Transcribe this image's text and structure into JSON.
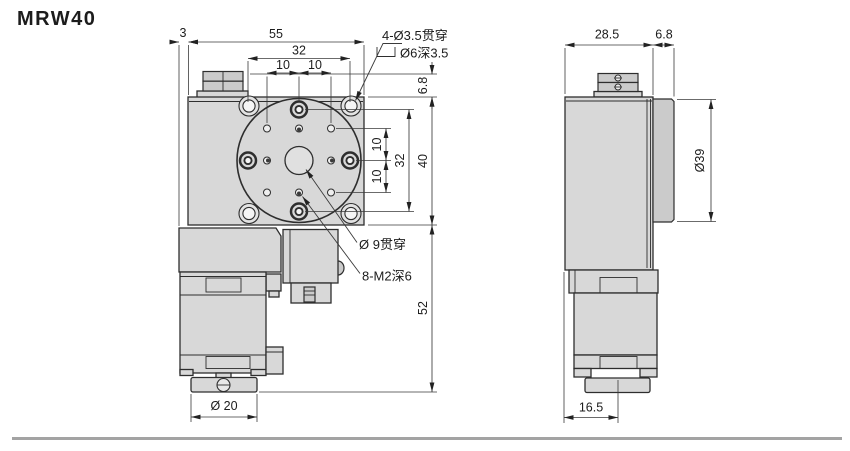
{
  "title": "MRW40",
  "colors": {
    "body_fill": "#d8d8d8",
    "body_fill_dark": "#cbcbcb",
    "line": "#2e2e2e",
    "dim": "#3a3a3a",
    "text": "#1c1c1c",
    "ground": "#a3a3a3",
    "bg": "#ffffff"
  },
  "front_view": {
    "dim_offset_3": "3",
    "dim_width_55": "55",
    "dim_holes_32_top": "32",
    "dim_holes_10_top_left": "10",
    "dim_holes_10_top_right": "10",
    "dim_knob_6_8": "6.8",
    "dim_holes_10_right_upper": "10",
    "dim_holes_32_right": "32",
    "dim_holes_10_right_lower": "10",
    "dim_height_40": "40",
    "dim_lower_52": "52",
    "dim_motor_dia_20": "Ø 20",
    "callout_corner_line1": "4-Ø3.5贯穿",
    "callout_corner_line2": "Ø6深3.5",
    "callout_center_hole": "Ø 9贯穿",
    "callout_thread": "8-M2深6"
  },
  "side_view": {
    "dim_depth_28_5": "28.5",
    "dim_table_6_8": "6.8",
    "dim_table_dia_39": "Ø39",
    "dim_center_16_5": "16.5"
  }
}
